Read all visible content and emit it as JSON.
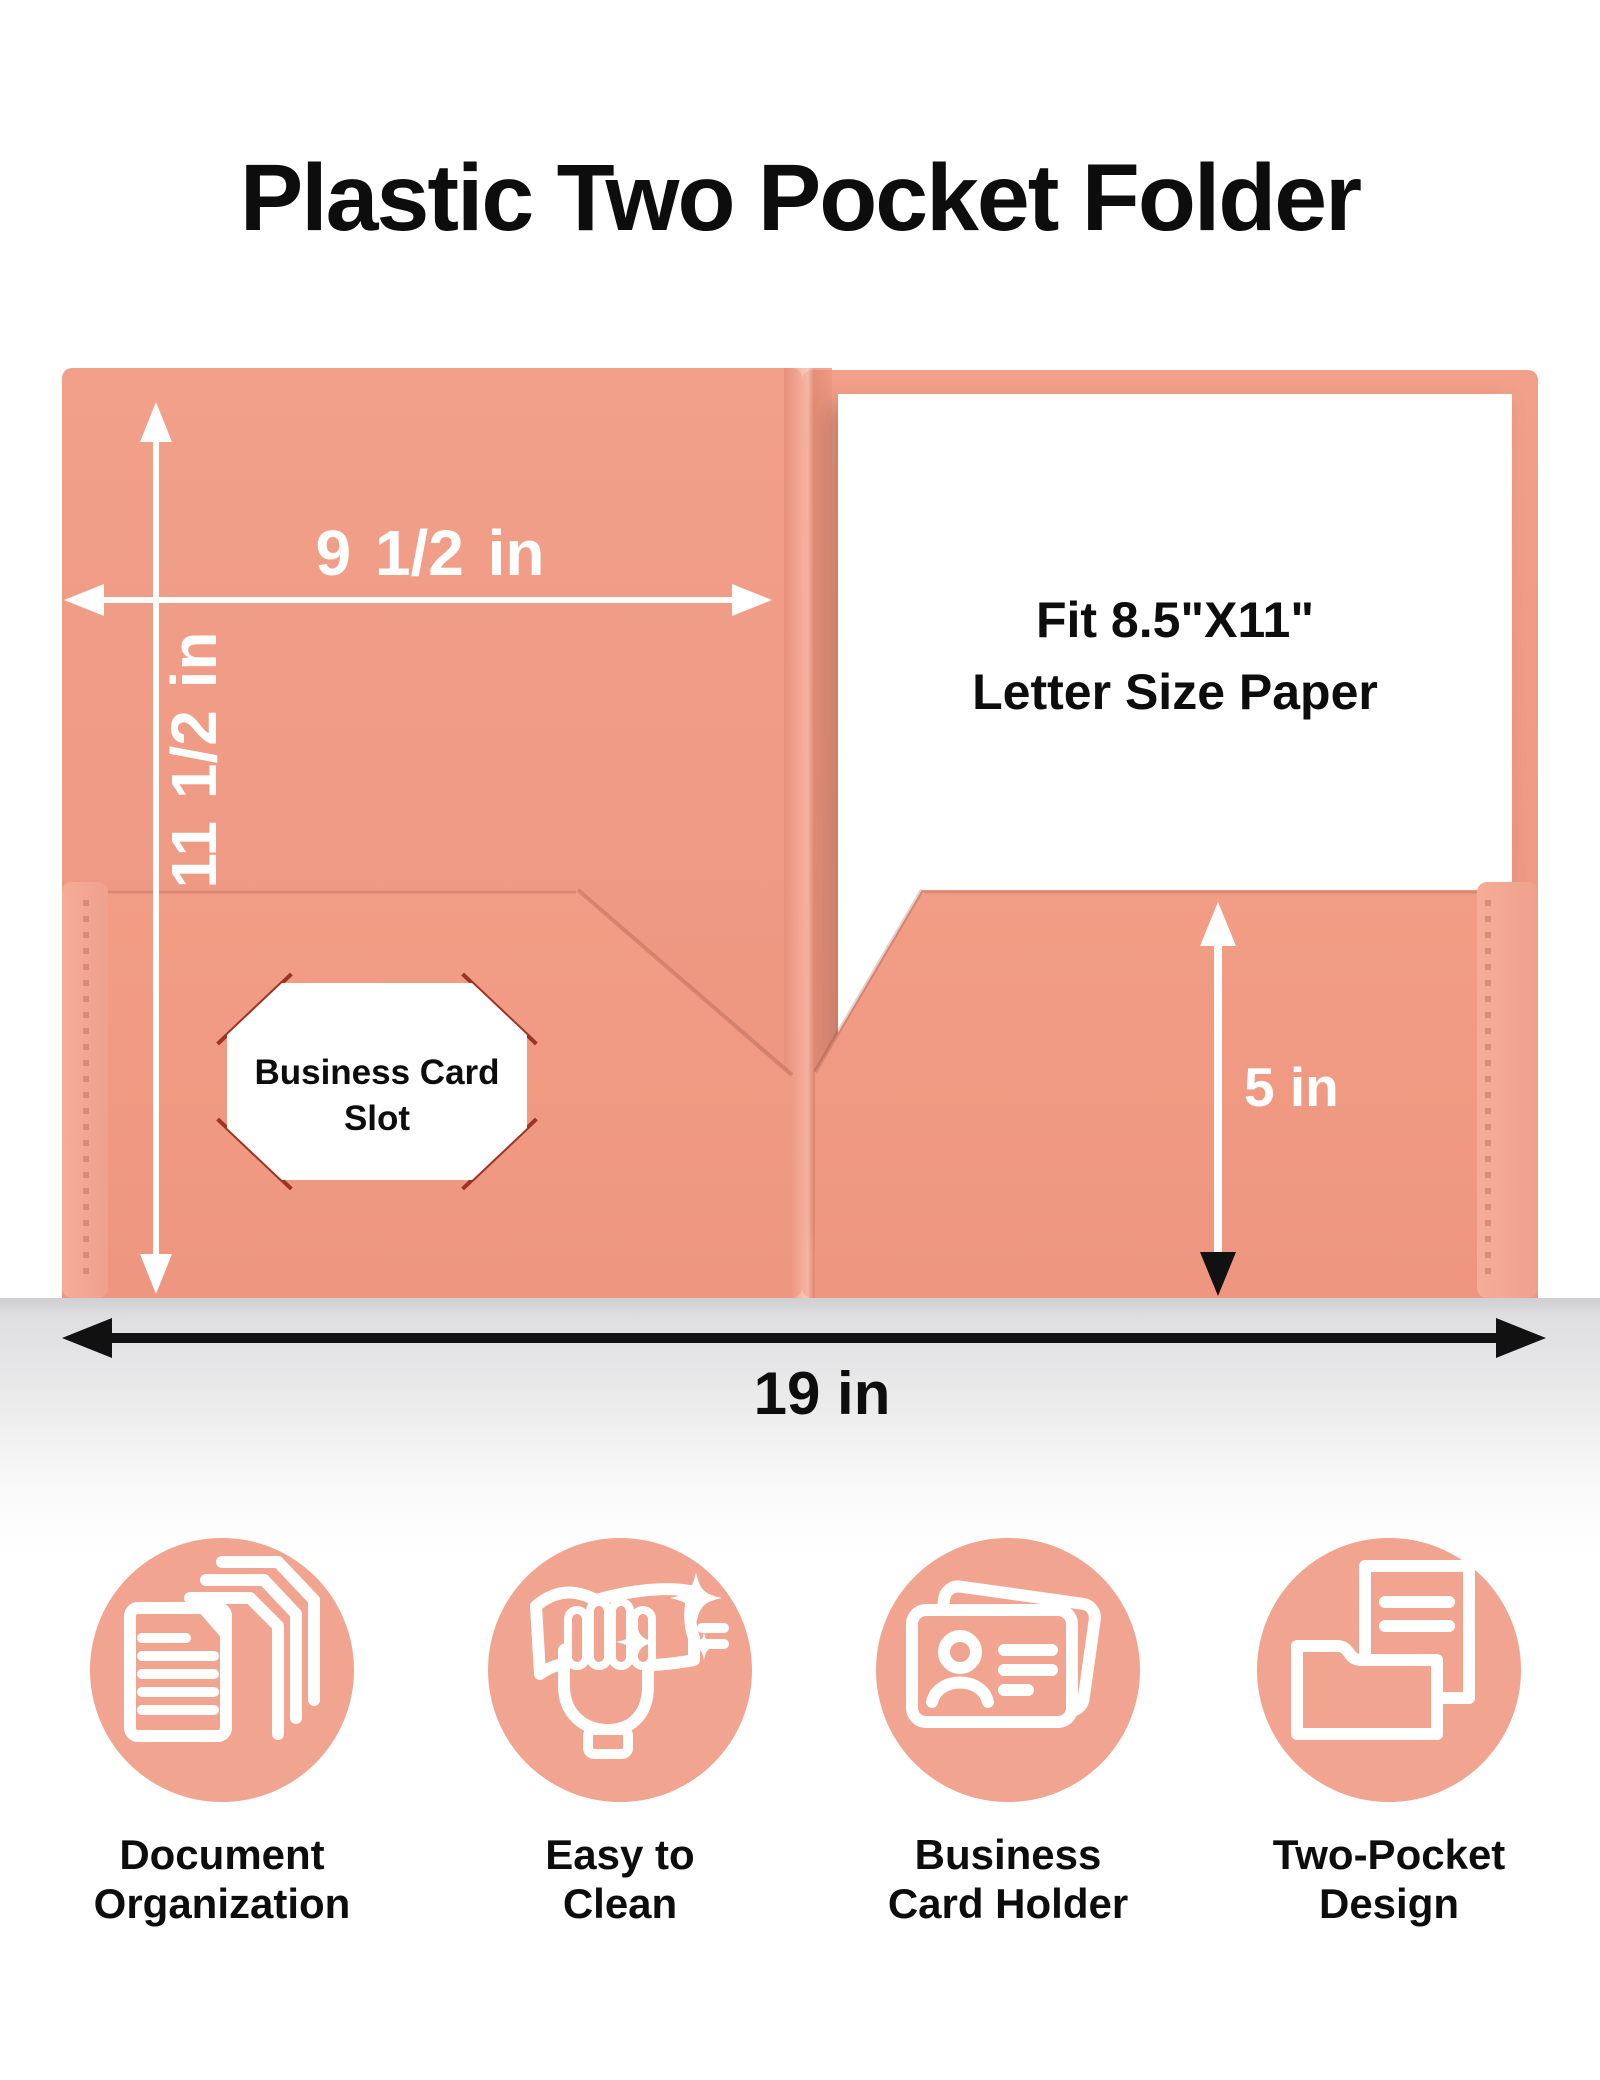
{
  "title": "Plastic Two Pocket Folder",
  "colors": {
    "folder_salmon": "#EE977F",
    "folder_salmon_light": "#F2A08A",
    "folder_salmon_dark": "#EC947E",
    "pocket_salmon": "#F09B84",
    "binding_strip": "#F4AB95",
    "stitch": "#D78C76",
    "feature_circle": "#F1A48F",
    "ink": "#0D0D0D",
    "dimension_white": "#FFFFFF",
    "card_slot_tick": "#9C3423",
    "reflection_gray": "#DEDEE0"
  },
  "folder_diagram": {
    "width_label": "9 1/2 in",
    "height_label": "11 1/2 in",
    "pocket_depth_label": "5 in",
    "total_width_label": "19 in",
    "paper_note_line1": "Fit 8.5\"X11\"",
    "paper_note_line2": "Letter Size Paper",
    "card_slot_line1": "Business Card",
    "card_slot_line2": "Slot"
  },
  "features": [
    {
      "icon": "document-stack-icon",
      "lines": [
        "Document",
        "Organization"
      ]
    },
    {
      "icon": "sparkle-clean-hand-icon",
      "lines": [
        "Easy to",
        "Clean"
      ]
    },
    {
      "icon": "business-card-icon",
      "lines": [
        "Business",
        "Card Holder"
      ]
    },
    {
      "icon": "two-pocket-folder-icon",
      "lines": [
        "Two-Pocket",
        "Design"
      ]
    }
  ]
}
